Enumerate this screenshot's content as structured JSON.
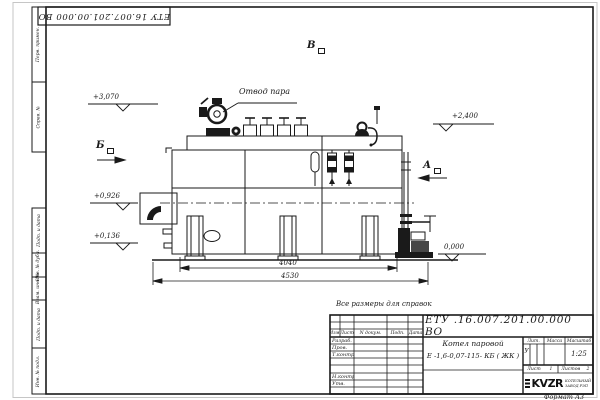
{
  "sheet": {
    "top_stamp": "ЕТУ 16.007.201.00.000  ВО",
    "ref_note": "Все размеры для справок",
    "format_note": "Формат  А3",
    "margin_labels": [
      "Перв. примен.",
      "Справ. №",
      "Подп. и дата",
      "Инв. № дубл.",
      "Взам. инв. №",
      "Подп. и дата",
      "Инв. № подл."
    ]
  },
  "drawing": {
    "steam_callout": "Отвод пара",
    "elev_3070": "+3,070",
    "elev_2400": "+2,400",
    "elev_0926": "+0,926",
    "elev_0136": "+0,136",
    "elev_0000": "0,000",
    "view_a": "А",
    "view_b": "Б",
    "view_v": "В",
    "dim_inner": "4040",
    "dim_outer": "4530"
  },
  "titleblock": {
    "doc_number": "ЕТУ .16.007.201.00.000  ВО",
    "product_name": "Котел паровой",
    "product_type": "Е -1,6-0,07-115- КБ ( ЖК )",
    "col_izm": "Изм.",
    "col_list": "Лист",
    "col_ndoc": "N докум.",
    "col_podp": "Подп.",
    "col_data": "Дата",
    "row_razrab": "Разраб.",
    "row_prov": "Пров.",
    "row_tkontr": "Т.контр.",
    "row_nkontr": "Н.контр.",
    "row_utv": "Утв.",
    "lit_label": "Лит.",
    "lit_value": "У",
    "mass_label": "Масса",
    "scale_label": "Масштаб",
    "scale_value": "1:25",
    "list_label": "Лист",
    "list_value": "1",
    "listov_label": "Листов",
    "listov_value": "2",
    "logo_text": "KVZR",
    "logo_line1": "КОТЕЛЬНЫЙ",
    "logo_line2": "ЗАВОД РЭП"
  }
}
